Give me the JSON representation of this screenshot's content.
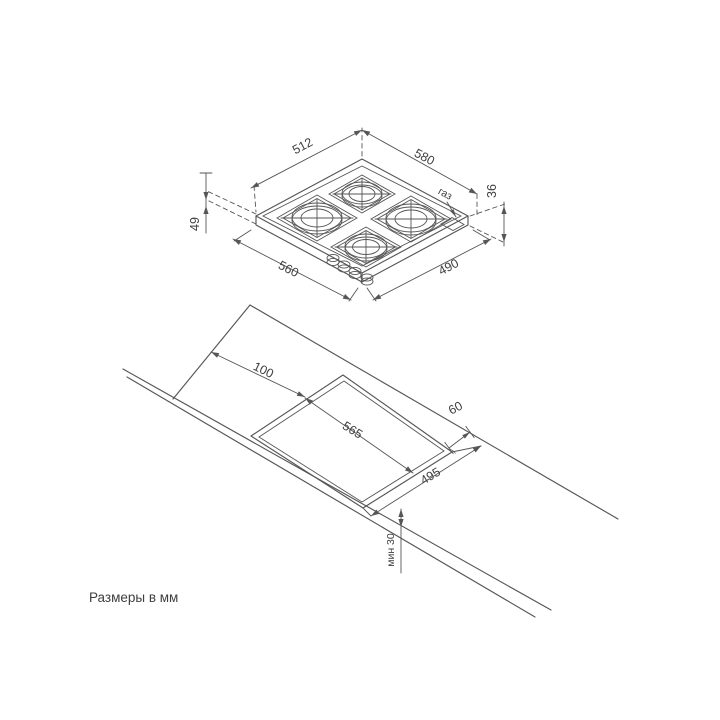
{
  "note": "Размеры в мм",
  "colors": {
    "line": "#565656",
    "text": "#3f3f3f",
    "background": "#ffffff"
  },
  "hob_view": {
    "dimensions": {
      "edge_back_left": "512",
      "edge_back_right": "580",
      "edge_front_left": "560",
      "edge_front_right": "490",
      "height_left": "49",
      "height_right": "36",
      "gas_label": "газ"
    },
    "burner_count": "4",
    "knob_count": "4"
  },
  "worktop_view": {
    "dimensions": {
      "offset_side": "100",
      "cutout_width": "565",
      "cutout_depth": "495",
      "clearance_back": "60",
      "clearance_front_min": "мин 30"
    }
  }
}
